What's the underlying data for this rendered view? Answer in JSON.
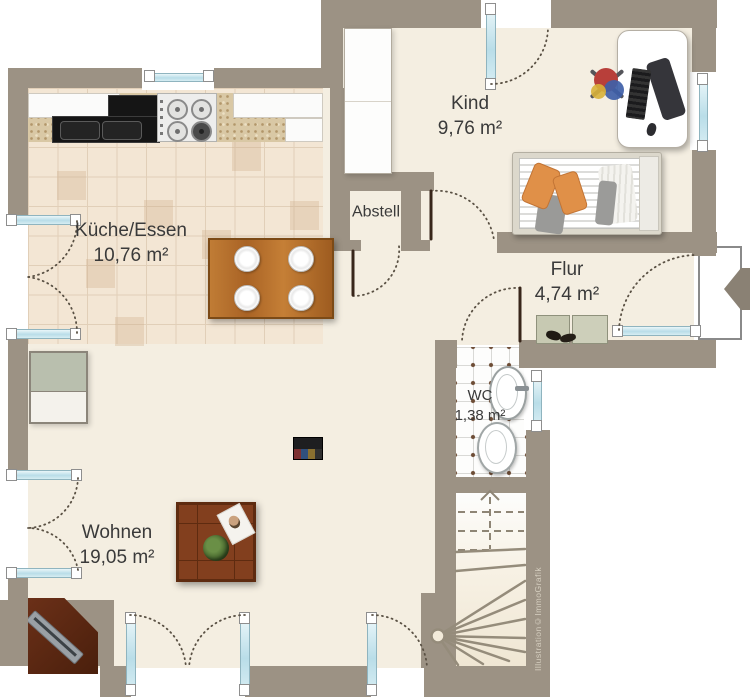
{
  "credit": "Illustration©ImmoGrafik",
  "rooms": {
    "kueche": {
      "name": "Küche/Essen",
      "area": "10,76 m²"
    },
    "abstell": {
      "name": "Abstell"
    },
    "kind": {
      "name": "Kind",
      "area": "9,76 m²"
    },
    "flur": {
      "name": "Flur",
      "area": "4,74 m²"
    },
    "wc": {
      "name": "WC",
      "area": "1,38 m²"
    },
    "wohnen": {
      "name": "Wohnen",
      "area": "19,05 m²"
    }
  },
  "colors": {
    "wall": "#9c9284",
    "floor_cream": "#f4eee1",
    "kitchen_tile": "#f3e6d4",
    "window_glazing": "#b9dde8",
    "table_wood": "#b5762f",
    "pillow_orange": "#e09048",
    "entry_arrow": "#8a8174"
  }
}
